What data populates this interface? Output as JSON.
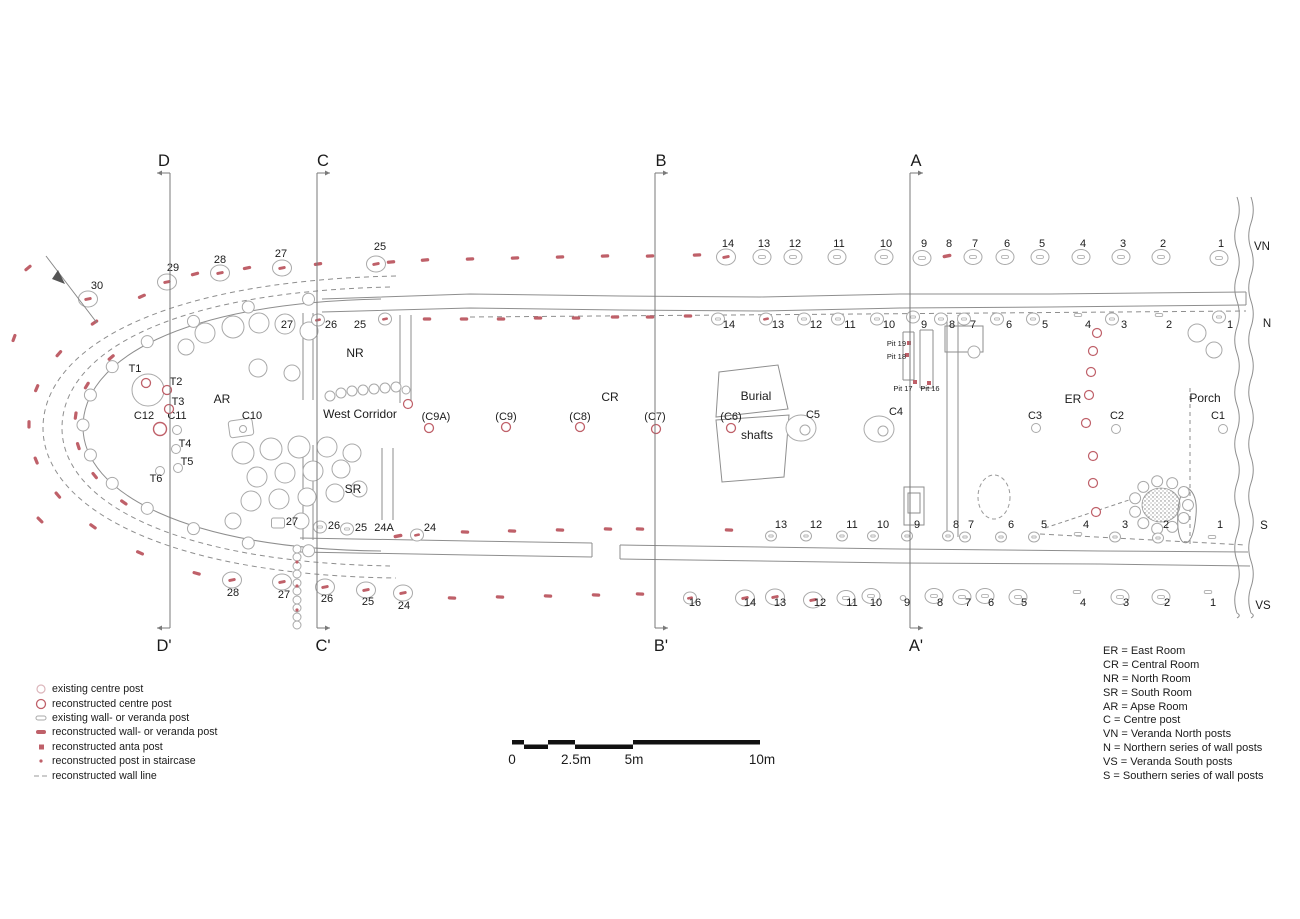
{
  "colors": {
    "red": "#bf6069",
    "pale_red": "#dcb6bb",
    "gray_line": "#8e8e8e",
    "stone": "#a9a9a9",
    "text": "#1b1b1b"
  },
  "sections": [
    {
      "top": "D",
      "bottom": "D'",
      "x": 170,
      "arrow": "left"
    },
    {
      "top": "C",
      "bottom": "C'",
      "x": 317,
      "arrow": "right"
    },
    {
      "top": "B",
      "bottom": "B'",
      "x": 655,
      "arrow": "right"
    },
    {
      "top": "A",
      "bottom": "A'",
      "x": 910,
      "arrow": "right"
    }
  ],
  "row_labels": [
    [
      "VN",
      1262,
      250
    ],
    [
      "N",
      1267,
      327
    ],
    [
      "S",
      1264,
      529
    ],
    [
      "VS",
      1263,
      609
    ]
  ],
  "rooms": [
    [
      "NR",
      355,
      357
    ],
    [
      "West Corridor",
      360,
      418
    ],
    [
      "AR",
      222,
      403
    ],
    [
      "SR",
      353,
      493
    ],
    [
      "CR",
      610,
      401
    ],
    [
      "Burial",
      756,
      400
    ],
    [
      "shafts",
      757,
      439
    ],
    [
      "ER",
      1073,
      403
    ],
    [
      "Porch",
      1205,
      402
    ]
  ],
  "pits": [
    [
      "Pit 19",
      906,
      346,
      "end"
    ],
    [
      "Pit 18",
      906,
      359,
      "end"
    ],
    [
      "Pit 17",
      903,
      391,
      "middle"
    ],
    [
      "Pit 16",
      930,
      391,
      "middle"
    ]
  ],
  "posts": [
    [
      "30",
      97,
      289,
      88,
      299,
      "cr"
    ],
    [
      "29",
      173,
      271,
      167,
      282,
      "cr"
    ],
    [
      "28",
      220,
      263,
      220,
      273,
      "cr"
    ],
    [
      "27",
      281,
      257,
      282,
      268,
      "cr"
    ],
    [
      "25",
      380,
      250,
      376,
      264,
      "cr"
    ],
    [
      "14",
      728,
      247,
      726,
      257,
      "cr"
    ],
    [
      "13",
      764,
      247,
      762,
      257,
      "cg"
    ],
    [
      "12",
      795,
      247,
      793,
      257,
      "cg"
    ],
    [
      "11",
      839,
      247,
      837,
      257,
      "cg"
    ],
    [
      "10",
      886,
      247,
      884,
      257,
      "cg"
    ],
    [
      "9",
      924,
      247,
      922,
      258,
      "cg"
    ],
    [
      "8",
      949,
      247,
      947,
      256,
      "dr"
    ],
    [
      "7",
      975,
      247,
      973,
      257,
      "cg"
    ],
    [
      "6",
      1007,
      247,
      1005,
      257,
      "cg"
    ],
    [
      "5",
      1042,
      247,
      1040,
      257,
      "cg"
    ],
    [
      "4",
      1083,
      247,
      1081,
      257,
      "cg"
    ],
    [
      "3",
      1123,
      247,
      1121,
      257,
      "cg"
    ],
    [
      "2",
      1163,
      247,
      1161,
      257,
      "cg"
    ],
    [
      "1",
      1221,
      247,
      1219,
      258,
      "cg"
    ],
    [
      "27",
      287,
      328,
      0,
      0,
      null
    ],
    [
      "26",
      331,
      328,
      318,
      320,
      "cr2"
    ],
    [
      "25",
      360,
      328,
      385,
      319,
      "cr2"
    ],
    [
      "14",
      729,
      328,
      718,
      319,
      "cg2"
    ],
    [
      "13",
      778,
      328,
      766,
      319,
      "cr2"
    ],
    [
      "12",
      816,
      328,
      804,
      319,
      "cg2"
    ],
    [
      "11",
      850,
      328,
      838,
      319,
      "cg2"
    ],
    [
      "10",
      889,
      328,
      877,
      319,
      "cg2"
    ],
    [
      "9",
      924,
      328,
      913,
      317,
      "cg2"
    ],
    [
      "8",
      952,
      328,
      941,
      319,
      "cg2"
    ],
    [
      "7",
      973,
      328,
      964,
      319,
      "cg2"
    ],
    [
      "6",
      1009,
      328,
      997,
      319,
      "cg2"
    ],
    [
      "5",
      1045,
      328,
      1033,
      319,
      "cg2"
    ],
    [
      "4",
      1088,
      328,
      1078,
      315,
      "dg"
    ],
    [
      "3",
      1124,
      328,
      1112,
      319,
      "cg2"
    ],
    [
      "2",
      1169,
      328,
      1159,
      315,
      "dg"
    ],
    [
      "1",
      1230,
      328,
      1219,
      317,
      "cg2"
    ],
    [
      "C12",
      144,
      419,
      160,
      429,
      "rc6"
    ],
    [
      "C11",
      177,
      419,
      177,
      430,
      "gc"
    ],
    [
      "C10",
      252,
      419,
      241,
      428,
      "sq"
    ],
    [
      "T1",
      135,
      372,
      146,
      383,
      "rc"
    ],
    [
      "T2",
      176,
      385,
      167,
      390,
      "rc"
    ],
    [
      "T3",
      178,
      405,
      169,
      409,
      "rc"
    ],
    [
      "T4",
      185,
      447,
      176,
      449,
      "gc"
    ],
    [
      "T5",
      187,
      465,
      178,
      468,
      "gc"
    ],
    [
      "T6",
      156,
      482,
      160,
      471,
      "gc"
    ],
    [
      "(C9A)",
      436,
      420,
      429,
      428,
      "rc"
    ],
    [
      "(C9)",
      506,
      420,
      506,
      427,
      "rc"
    ],
    [
      "(C8)",
      580,
      420,
      580,
      427,
      "rc"
    ],
    [
      "(C7)",
      655,
      420,
      656,
      429,
      "rc"
    ],
    [
      "(C6)",
      731,
      420,
      731,
      428,
      "rc"
    ],
    [
      "C5",
      813,
      418,
      801,
      428,
      "stone2"
    ],
    [
      "C4",
      896,
      415,
      879,
      429,
      "stone2"
    ],
    [
      "C3",
      1035,
      419,
      1036,
      428,
      "gc"
    ],
    [
      "C2",
      1117,
      419,
      1116,
      429,
      "gc"
    ],
    [
      "C1",
      1218,
      419,
      1223,
      429,
      "gc"
    ],
    [
      "27",
      292,
      525,
      278,
      523,
      "sq2"
    ],
    [
      "26",
      334,
      529,
      320,
      527,
      "cg2"
    ],
    [
      "25",
      361,
      531,
      347,
      529,
      "cg2"
    ],
    [
      "24A",
      384,
      531,
      398,
      536,
      "dr"
    ],
    [
      "24",
      430,
      531,
      417,
      535,
      "cr2"
    ],
    [
      "13",
      781,
      528,
      771,
      536,
      "sg"
    ],
    [
      "12",
      816,
      528,
      806,
      536,
      "sg"
    ],
    [
      "11",
      852,
      528,
      842,
      536,
      "sg"
    ],
    [
      "10",
      883,
      528,
      873,
      536,
      "sg"
    ],
    [
      "9",
      917,
      528,
      907,
      536,
      "sg"
    ],
    [
      "8",
      956,
      528,
      948,
      536,
      "sg"
    ],
    [
      "7",
      971,
      528,
      965,
      537,
      "sg"
    ],
    [
      "6",
      1011,
      528,
      1001,
      537,
      "sg"
    ],
    [
      "5",
      1044,
      528,
      1034,
      537,
      "sg"
    ],
    [
      "4",
      1086,
      528,
      1078,
      534,
      "dg"
    ],
    [
      "3",
      1125,
      528,
      1115,
      537,
      "sg"
    ],
    [
      "2",
      1166,
      528,
      1158,
      538,
      "sg"
    ],
    [
      "1",
      1220,
      528,
      1212,
      537,
      "dg"
    ],
    [
      "28",
      233,
      596,
      232,
      580,
      "cr"
    ],
    [
      "27",
      284,
      598,
      282,
      582,
      "cr"
    ],
    [
      "26",
      327,
      602,
      325,
      587,
      "cr"
    ],
    [
      "25",
      368,
      605,
      366,
      590,
      "cr"
    ],
    [
      "24",
      404,
      609,
      403,
      593,
      "cr"
    ],
    [
      "16",
      695,
      606,
      690,
      598,
      "cr2"
    ],
    [
      "14",
      750,
      606,
      745,
      598,
      "cr"
    ],
    [
      "13",
      780,
      606,
      775,
      597,
      "cr"
    ],
    [
      "12",
      820,
      606,
      813,
      600,
      "cr"
    ],
    [
      "11",
      852,
      606,
      846,
      598,
      "cg"
    ],
    [
      "10",
      876,
      606,
      871,
      596,
      "cg"
    ],
    [
      "9",
      907,
      606,
      903,
      598,
      "tiny"
    ],
    [
      "8",
      940,
      606,
      934,
      596,
      "cg"
    ],
    [
      "7",
      968,
      606,
      962,
      597,
      "cg"
    ],
    [
      "6",
      991,
      606,
      985,
      596,
      "cg"
    ],
    [
      "5",
      1024,
      606,
      1018,
      597,
      "cg"
    ],
    [
      "4",
      1083,
      606,
      1077,
      592,
      "dg"
    ],
    [
      "3",
      1126,
      606,
      1120,
      597,
      "cg"
    ],
    [
      "2",
      1167,
      606,
      1161,
      597,
      "cg"
    ],
    [
      "1",
      1213,
      606,
      1208,
      592,
      "dg"
    ]
  ],
  "red_dashes": [
    [
      195,
      274,
      -15
    ],
    [
      247,
      268,
      -12
    ],
    [
      318,
      264,
      -8
    ],
    [
      391,
      262,
      -5
    ],
    [
      425,
      260,
      -5
    ],
    [
      470,
      259,
      -3
    ],
    [
      515,
      258,
      -3
    ],
    [
      560,
      257,
      -2
    ],
    [
      605,
      256,
      -2
    ],
    [
      650,
      256,
      -2
    ],
    [
      697,
      255,
      -2
    ],
    [
      427,
      319,
      0
    ],
    [
      464,
      319,
      0
    ],
    [
      501,
      319,
      0
    ],
    [
      538,
      318,
      0
    ],
    [
      576,
      318,
      0
    ],
    [
      615,
      317,
      0
    ],
    [
      650,
      317,
      0
    ],
    [
      688,
      316,
      0
    ],
    [
      465,
      532,
      2
    ],
    [
      512,
      531,
      2
    ],
    [
      560,
      530,
      2
    ],
    [
      608,
      529,
      2
    ],
    [
      640,
      529,
      2
    ],
    [
      729,
      530,
      2
    ],
    [
      452,
      598,
      3
    ],
    [
      500,
      597,
      3
    ],
    [
      548,
      596,
      3
    ],
    [
      596,
      595,
      3
    ],
    [
      640,
      594,
      3
    ],
    [
      28,
      268,
      -40
    ],
    [
      14,
      338,
      -70
    ],
    [
      40,
      520,
      45
    ]
  ],
  "ring_dashes": {
    "cx": 345,
    "cy": 425,
    "rx": 316,
    "ry": 168,
    "a1": 130,
    "a2": 242,
    "n": 10
  },
  "ring_dashes2": {
    "cx": 345,
    "cy": 425,
    "rx": 270,
    "ry": 135,
    "a1": 150,
    "a2": 215,
    "n": 6
  },
  "wall_stone_ring": {
    "cx": 345,
    "cy": 425,
    "rx": 262,
    "ry": 127,
    "a1": 98,
    "a2": 262,
    "n": 13,
    "r": 6
  },
  "anta_squares": [
    [
      909,
      343
    ],
    [
      907,
      355
    ],
    [
      915,
      382
    ],
    [
      929,
      383
    ]
  ],
  "stair_dots": [
    [
      297,
      562
    ],
    [
      297,
      586
    ],
    [
      297,
      610
    ]
  ],
  "red_circles": [
    [
      1097,
      333
    ],
    [
      1093,
      351
    ],
    [
      1091,
      372
    ],
    [
      1089,
      395
    ],
    [
      1086,
      423
    ],
    [
      1093,
      456
    ],
    [
      1093,
      483
    ],
    [
      1096,
      512
    ],
    [
      408,
      404
    ]
  ],
  "stones": [
    [
      205,
      333,
      10
    ],
    [
      233,
      327,
      11
    ],
    [
      259,
      323,
      10
    ],
    [
      285,
      324,
      10
    ],
    [
      309,
      331,
      9
    ],
    [
      186,
      347,
      8
    ],
    [
      148,
      390,
      16
    ],
    [
      258,
      368,
      9
    ],
    [
      292,
      373,
      8
    ],
    [
      243,
      453,
      11
    ],
    [
      271,
      449,
      11
    ],
    [
      299,
      447,
      11
    ],
    [
      327,
      447,
      10
    ],
    [
      352,
      453,
      9
    ],
    [
      257,
      477,
      10
    ],
    [
      285,
      473,
      10
    ],
    [
      313,
      471,
      10
    ],
    [
      341,
      469,
      9
    ],
    [
      251,
      501,
      10
    ],
    [
      279,
      499,
      10
    ],
    [
      307,
      497,
      9
    ],
    [
      335,
      493,
      9
    ],
    [
      359,
      489,
      8
    ],
    [
      233,
      521,
      8
    ],
    [
      301,
      521,
      8
    ],
    [
      330,
      396,
      5
    ],
    [
      341,
      393,
      5
    ],
    [
      352,
      391,
      5
    ],
    [
      363,
      390,
      5
    ],
    [
      374,
      389,
      5
    ],
    [
      385,
      388,
      5
    ],
    [
      396,
      387,
      5
    ],
    [
      406,
      390,
      4
    ],
    [
      297,
      549,
      4
    ],
    [
      297,
      557,
      4
    ],
    [
      297,
      566,
      4
    ],
    [
      297,
      574,
      4
    ],
    [
      297,
      583,
      4
    ],
    [
      297,
      591,
      4
    ],
    [
      297,
      600,
      4
    ],
    [
      297,
      608,
      4
    ],
    [
      297,
      617,
      4
    ],
    [
      297,
      625,
      4
    ],
    [
      1197,
      333,
      9
    ],
    [
      1214,
      350,
      8
    ],
    [
      974,
      352,
      6
    ]
  ],
  "hearth": {
    "cx": 1161,
    "cy": 505,
    "ring_r": 27,
    "n_stones": 11,
    "stone_r": 5.5,
    "rx": 19,
    "ry": 17
  },
  "legend_left": {
    "items": [
      {
        "sym": "circle-pale",
        "label": "existing centre post"
      },
      {
        "sym": "circle-red",
        "label": "reconstructed centre post"
      },
      {
        "sym": "dash-gray",
        "label": "existing wall- or veranda post"
      },
      {
        "sym": "dash-red",
        "label": "reconstructed wall- or veranda post"
      },
      {
        "sym": "square-red",
        "label": "reconstructed anta post"
      },
      {
        "sym": "dot-red",
        "label": "reconstructed post in staircase"
      },
      {
        "sym": "dashline-gray",
        "label": "reconstructed wall line"
      }
    ]
  },
  "legend_right": {
    "items": [
      "ER = East Room",
      "CR = Central Room",
      "NR = North Room",
      "SR = South Room",
      "AR = Apse Room",
      "C = Centre post",
      "VN = Veranda North posts",
      "N = Northern series of wall posts",
      "VS = Veranda South posts",
      "S = Southern series of wall posts"
    ]
  },
  "scale": {
    "top": [
      [
        512,
        12
      ],
      [
        548,
        27
      ],
      [
        633,
        127
      ]
    ],
    "bottom": [
      [
        524,
        24
      ],
      [
        575,
        58
      ]
    ],
    "labels": [
      [
        "0",
        512
      ],
      [
        "2.5m",
        576
      ],
      [
        "5m",
        634
      ],
      [
        "10m",
        762
      ]
    ],
    "y": 740,
    "h": 4.5,
    "label_y": 764
  }
}
